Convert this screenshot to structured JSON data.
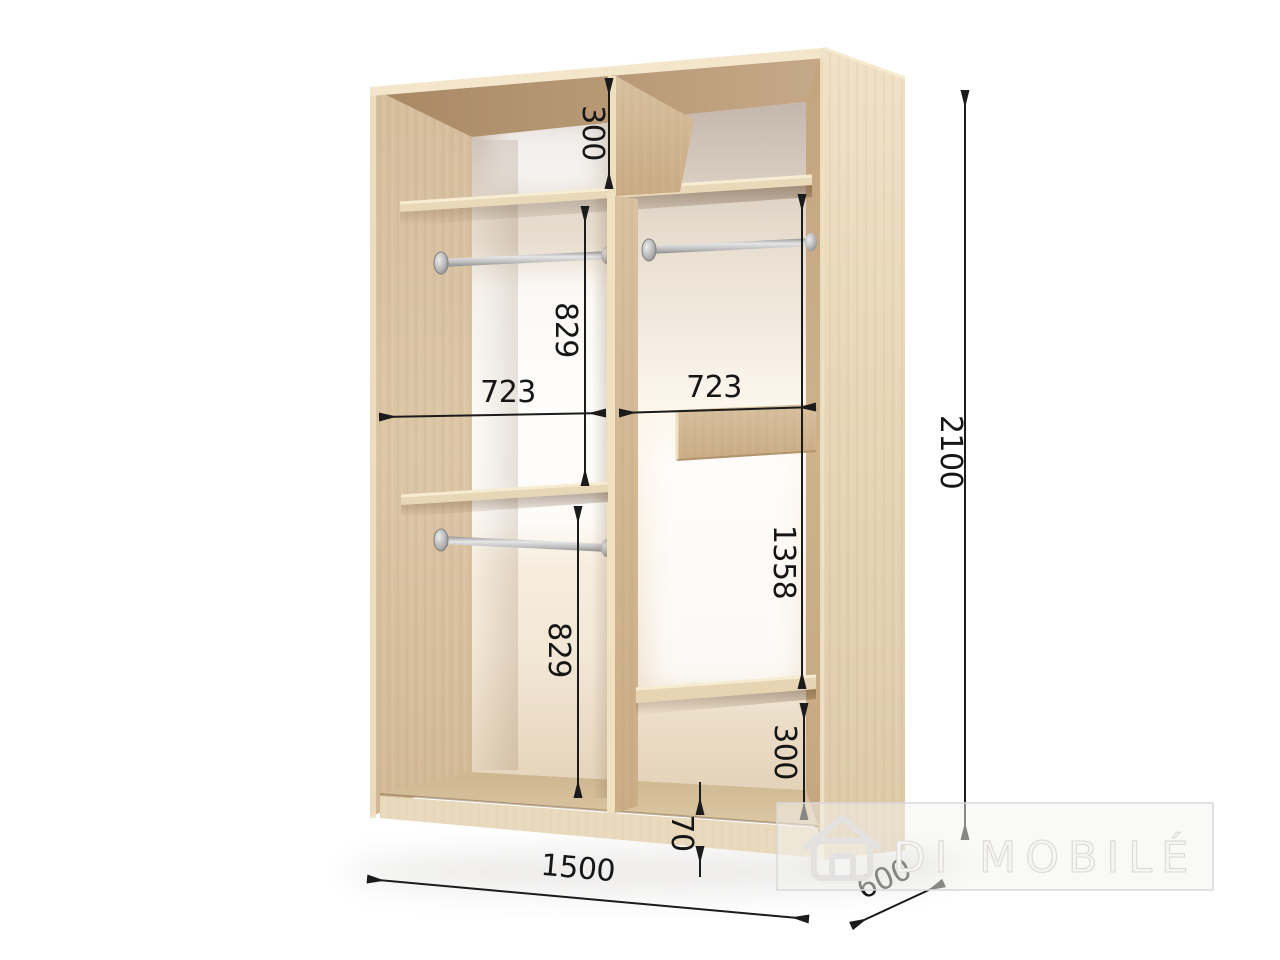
{
  "diagram": {
    "watermark": {
      "brand": "DI MOBILÉ"
    },
    "dimensions": {
      "top_shelf_section_height": "300",
      "upper_hanging_height_left": "829",
      "left_compartment_width": "723",
      "right_compartment_width": "723",
      "lower_hanging_height_left": "829",
      "right_middle_section_height": "1358",
      "bottom_shelf_section_height_right": "300",
      "plinth_height": "70",
      "overall_width": "1500",
      "overall_depth": "600",
      "overall_height": "2100"
    },
    "colors": {
      "wood_light": "#ecdcc0",
      "wood_medium": "#d8c09e",
      "wood_dark": "#b8997a",
      "back_wall_bright": "#fdf7ee",
      "back_wall_shadow": "#c3b6ac",
      "rod_silver": "#c9c9c9",
      "dimension_line": "#1b1b1b",
      "watermark_gray": "#e2e1e0"
    }
  }
}
